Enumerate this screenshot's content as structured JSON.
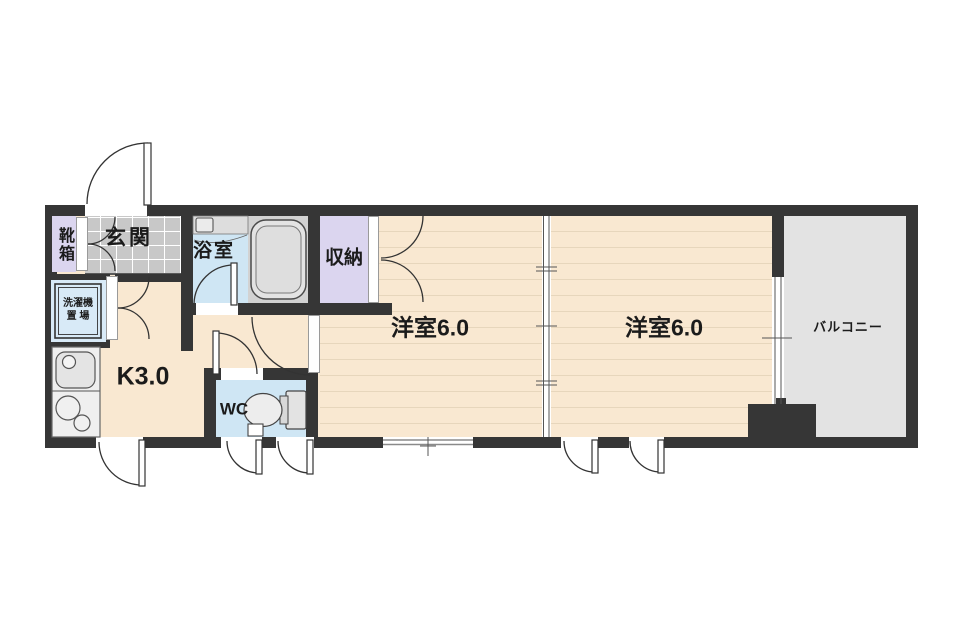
{
  "floorplan": {
    "type": "apartment-floor-plan",
    "rooms": {
      "shoebox": {
        "label": "靴箱"
      },
      "genkan": {
        "label": "玄関"
      },
      "laundry": {
        "label": "洗濯機\n置 場"
      },
      "bathroom": {
        "label": "浴室"
      },
      "closet": {
        "label": "収納"
      },
      "kitchen": {
        "label": "K3.0"
      },
      "wc": {
        "label": "WC"
      },
      "western_room_1": {
        "label": "洋室6.0"
      },
      "western_room_2": {
        "label": "洋室6.0"
      },
      "balcony": {
        "label": "バルコニー"
      }
    },
    "colors": {
      "wall": "#363636",
      "room_floor": "#F9E8D1",
      "floor_line": "#E7D6BC",
      "genkan_tile": "#C8C8C8",
      "closet_purple": "#DBD5EF",
      "water_blue": "#CFE6F4",
      "laundry_blue": "#D8EAF7",
      "fixture_gray": "#E3E3E3",
      "balcony_gray": "#E3E3E3"
    }
  }
}
